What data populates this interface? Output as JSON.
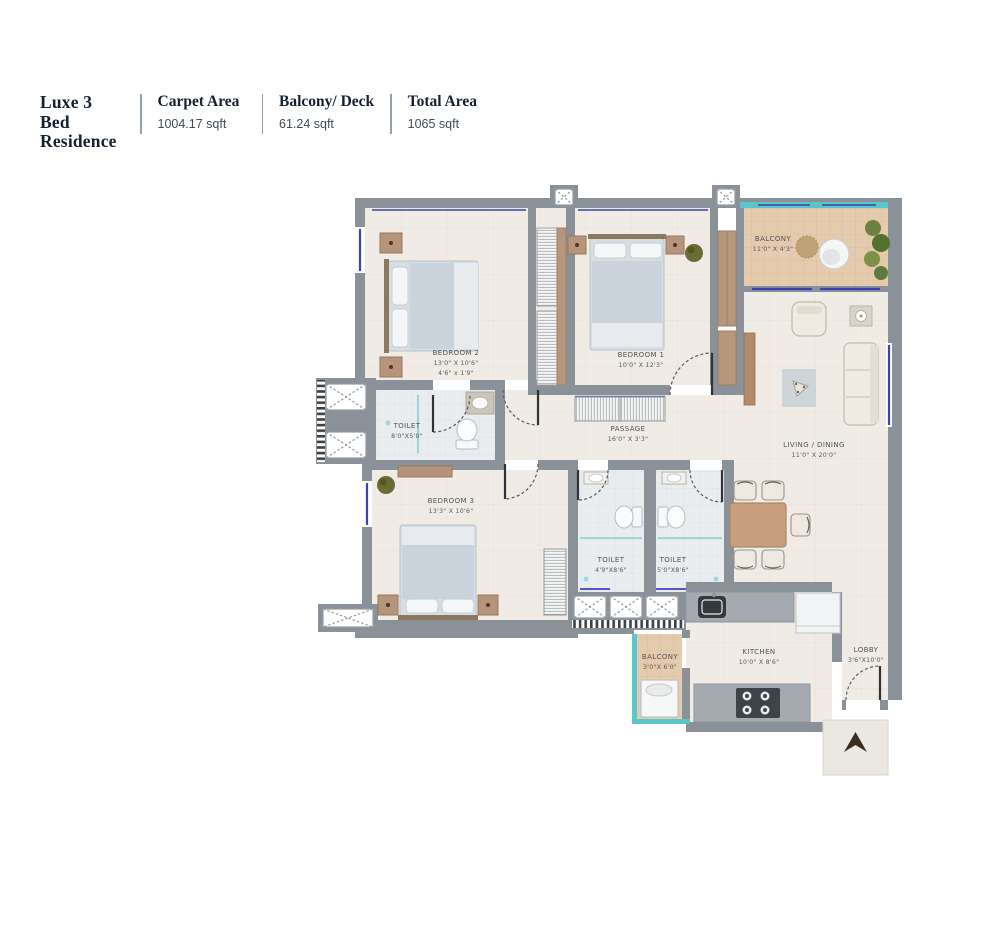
{
  "header": {
    "title_line1": "Luxe 3 Bed",
    "title_line2": "Residence",
    "stats": [
      {
        "label": "Carpet Area",
        "value": "1004.17 sqft"
      },
      {
        "label": "Balcony/ Deck",
        "value": "61.24 sqft"
      },
      {
        "label": "Total Area",
        "value": "1065 sqft"
      }
    ]
  },
  "rooms": {
    "bedroom2": {
      "name": "BEDROOM 2",
      "dim1": "13'0\" X 10'6\"",
      "dim2": "4'6\" x 1'9\""
    },
    "bedroom1": {
      "name": "BEDROOM 1",
      "dim": "10'0\" X 12'3\""
    },
    "balcony1": {
      "name": "BALCONY",
      "dim": "11'0\" X 4'3\""
    },
    "toilet1": {
      "name": "TOILET",
      "dim": "8'0\"X5'0\""
    },
    "passage": {
      "name": "PASSAGE",
      "dim": "16'0\" X 3'3\""
    },
    "living": {
      "name": "LIVING / DINING",
      "dim": "11'0\" X 20'0\""
    },
    "bedroom3": {
      "name": "BEDROOM 3",
      "dim": "13'3\" X 10'6\""
    },
    "toilet2": {
      "name": "TOILET",
      "dim": "4'9\"X8'6\""
    },
    "toilet3": {
      "name": "TOILET",
      "dim": "5'0\"X8'6\""
    },
    "balcony2": {
      "name": "BALCONY",
      "dim": "3'0\"X 6'0\""
    },
    "kitchen": {
      "name": "KITCHEN",
      "dim": "10'0\" X 8'6\""
    },
    "lobby": {
      "name": "LOBBY",
      "dim": "3'6\"X10'0\""
    }
  },
  "colors": {
    "wall": "#8A9199",
    "floor": "#F0ECE5",
    "balcony_floor": "#E5CBAD",
    "glass": "#59C6CC",
    "window": "#3A41B0",
    "title_ink": "#15202e"
  }
}
